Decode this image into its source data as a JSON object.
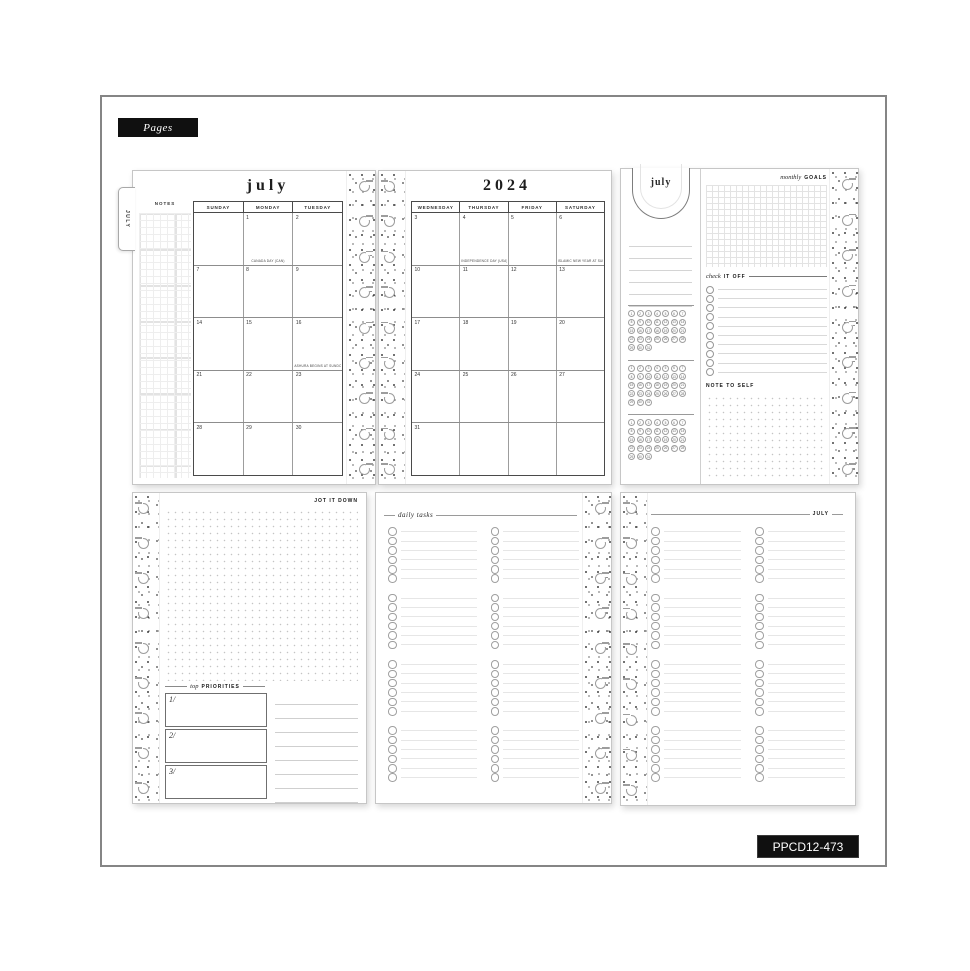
{
  "frame": {
    "pages_label": "Pages",
    "sku_label": "PPCD12-473"
  },
  "binding": {
    "disc_count": 9
  },
  "calendar_left": {
    "tab_label": "JULY",
    "title": "july",
    "notes_label": "NOTES",
    "day_headers": [
      "SUNDAY",
      "MONDAY",
      "TUESDAY"
    ],
    "weeks": [
      [
        {
          "day": ""
        },
        {
          "day": "1",
          "note": "CANADA DAY (CAN)"
        },
        {
          "day": "2"
        }
      ],
      [
        {
          "day": "7"
        },
        {
          "day": "8"
        },
        {
          "day": "9"
        }
      ],
      [
        {
          "day": "14"
        },
        {
          "day": "15"
        },
        {
          "day": "16",
          "note": "ASHURA BEGINS AT SUNDOWN (MUS)"
        }
      ],
      [
        {
          "day": "21"
        },
        {
          "day": "22"
        },
        {
          "day": "23"
        }
      ],
      [
        {
          "day": "28"
        },
        {
          "day": "29"
        },
        {
          "day": "30"
        }
      ]
    ]
  },
  "calendar_right": {
    "title": "2024",
    "day_headers": [
      "WEDNESDAY",
      "THURSDAY",
      "FRIDAY",
      "SATURDAY"
    ],
    "weeks": [
      [
        {
          "day": "3"
        },
        {
          "day": "4",
          "note": "INDEPENDENCE DAY (USA)"
        },
        {
          "day": "5"
        },
        {
          "day": "6",
          "note": "ISLAMIC NEW YEAR AT SUNDOWN (MUS)"
        }
      ],
      [
        {
          "day": "10"
        },
        {
          "day": "11"
        },
        {
          "day": "12"
        },
        {
          "day": "13"
        }
      ],
      [
        {
          "day": "17"
        },
        {
          "day": "18"
        },
        {
          "day": "19"
        },
        {
          "day": "20"
        }
      ],
      [
        {
          "day": "24"
        },
        {
          "day": "25"
        },
        {
          "day": "26"
        },
        {
          "day": "27"
        }
      ],
      [
        {
          "day": "31"
        },
        {
          "day": ""
        },
        {
          "day": ""
        },
        {
          "day": ""
        }
      ]
    ]
  },
  "dashboard": {
    "tab_label": "july",
    "goals_script": "monthly",
    "goals_bold": "GOALS",
    "check_script": "check",
    "check_bold": "IT OFF",
    "note_label": "NOTE TO SELF",
    "ruled_lines": 6,
    "tracker_blocks": 3,
    "tracker_days": [
      1,
      2,
      3,
      4,
      5,
      6,
      7,
      8,
      9,
      10,
      11,
      12,
      13,
      14,
      15,
      16,
      17,
      18,
      19,
      20,
      21,
      22,
      23,
      24,
      25,
      26,
      27,
      28,
      29,
      30,
      31
    ],
    "checklist_rows": 10
  },
  "jot_page": {
    "title": "JOT IT DOWN",
    "priorities_script": "top",
    "priorities_bold": "PRIORITIES",
    "priority_numbers": [
      "1/",
      "2/",
      "3/"
    ],
    "ruled_lines": 8
  },
  "daily_tasks_page": {
    "title": "daily tasks",
    "columns": 2,
    "groups": 4,
    "rows_per_group": 6
  },
  "july_list_page": {
    "title": "JULY",
    "columns": 2,
    "groups": 4,
    "rows_per_group": 6
  },
  "colors": {
    "label_bg": "#101010",
    "ink": "#222222",
    "page_border": "#c6c6c6"
  }
}
